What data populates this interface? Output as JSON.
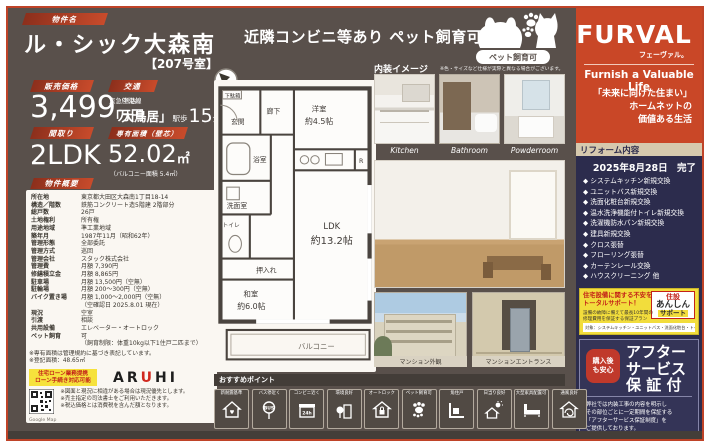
{
  "colors": {
    "page_brown": "#59504b",
    "brand_red": "#c94727",
    "navy": "#2c2c4d",
    "chip_red": "#c0452b",
    "yellow": "#f2dd3c",
    "tan_bar": "#d6c9ae"
  },
  "header": {
    "property_label": "物件名",
    "property_name": "ル・シック大森南",
    "room_no": "【207号室】",
    "banner_text": "近隣コンビニ等あり ペット飼育可能",
    "pet_badge": "ペット飼育可"
  },
  "brand": {
    "logo": "FURVAL",
    "logo_kana": "フェーヴァル。",
    "tagline": "Furnish a Valuable Life",
    "catch1": "「未来に向けた住まい」",
    "catch2": "ホームネットの",
    "catch3": "価値ある生活"
  },
  "summary": {
    "price_label": "販売価格",
    "price_value": "3,499",
    "price_tax": "（税込）",
    "price_unit": "万円",
    "access_label": "交通",
    "access_line": "京急空港線",
    "access_station": "「大鳥居」",
    "access_walk_prefix": "駅歩",
    "access_walk_min": "15",
    "access_walk_suffix": "分",
    "layout_label": "間取り",
    "layout_value": "2LDK",
    "area_label": "専有面積（壁芯）",
    "area_value": "52.02",
    "area_unit": "㎡",
    "balcony_note": "（バルコニー面積 5.4㎡）"
  },
  "overview": {
    "label": "物件概要",
    "rows": [
      [
        "所在地",
        "東京都大田区大森南1丁目18-14"
      ],
      [
        "構造／階数",
        "鉄筋コンクリート造5階建 2階部分"
      ],
      [
        "総戸数",
        "26戸"
      ],
      [
        "土地権利",
        "所有権"
      ],
      [
        "用途地域",
        "準工業地域"
      ],
      [
        "築年月",
        "1987年11月（昭和62年）"
      ],
      [
        "管理形態",
        "全部委託"
      ],
      [
        "管理方式",
        "巡回"
      ],
      [
        "管理会社",
        "スタック株式会社"
      ],
      [
        "管理費",
        "月額 7,390円"
      ],
      [
        "修繕積立金",
        "月額 8,865円"
      ],
      [
        "駐車場",
        "月額 13,500円（空無）"
      ],
      [
        "駐輪場",
        "月額 200〜300円（空無）"
      ],
      [
        "バイク置き場",
        "月額 1,000〜2,000円（空無）"
      ],
      [
        "",
        "（空確認日 2025.8.01 現在）"
      ],
      [
        "現況",
        "空室"
      ],
      [
        "引渡",
        "相談"
      ],
      [
        "共用設備",
        "エレベーター・オートロック"
      ],
      [
        "ペット飼育",
        "可"
      ],
      [
        "",
        "（飼育制限：体重10kg以下1住戸二匹まで）"
      ]
    ],
    "notes": [
      "※専有面積は管理規約に基づき表記しています。",
      "※登記面積：48.65㎡"
    ]
  },
  "loan": {
    "badge_line1": "住宅ローン業務提携",
    "badge_line2": "ローン手続き対応可能",
    "bank_a": "AR",
    "bank_u": "U",
    "bank_hi": "HI"
  },
  "map": {
    "qr_caption": "Google Map"
  },
  "disclaimers": [
    "※図面と現況に相違がある場合は現況優先とします。",
    "※売主指定の司法書士をご利用いただきます。",
    "※税込価格とは消費税を含んだ額となります。"
  ],
  "floorplan": {
    "getabako": "下駄箱",
    "genkan": "玄関",
    "rouka": "廊下",
    "youshitsu": "洋室",
    "youshitsu_size": "約4.5帖",
    "bath": "浴室",
    "senmen": "洗面室",
    "toilet": "トイレ",
    "oshiire": "押入れ",
    "washitsu": "和室",
    "washitsu_size": "約6.0帖",
    "ldk": "LDK",
    "ldk_size": "約13.2帖",
    "fridge": "R",
    "balcony": "バルコニー"
  },
  "interior": {
    "header": "内装イメージ",
    "note": "※色・サイズなど仕様が実際と異なる場合がございます。",
    "photos": [
      {
        "label": "Kitchen"
      },
      {
        "label": "Bathroom"
      },
      {
        "label": "Powderroom"
      }
    ]
  },
  "building_photos": [
    {
      "caption": "マンション外観"
    },
    {
      "caption": "マンションエントランス"
    }
  ],
  "reform": {
    "header": "リフォーム内容",
    "date": "2025年8月28日",
    "status": "完了",
    "items": [
      "システムキッチン新規交換",
      "ユニットバス新規交換",
      "洗面化粧台新規交換",
      "温水洗浄機能付トイレ新規交換",
      "洗濯機防水パン新規交換",
      "建具新規交換",
      "クロス張替",
      "フローリング張替",
      "カーテンレール交換",
      "ハウスクリーニング 他"
    ]
  },
  "support": {
    "title1": "住宅設備に関する不安を",
    "title2": "トータルサポート！",
    "desc1": "設備の故障に備えて最長10年間の",
    "desc2": "修理費用を保証する保証プラン",
    "logo1": "住設",
    "logo2": "あんしん",
    "logo3": "サポート",
    "targets": "対象：システムキッチン・ユニットバス・洗面化粧台・トイレ"
  },
  "warranty": {
    "tab1": "購入後",
    "tab2": "も安心",
    "line1": "アフター",
    "line2": "サービス",
    "line3": "保 証 付",
    "desc": [
      "弊社では内装工事の内容を明示し",
      "その部位ごとに一定期間を保証する",
      "「アフターサービス保証制度」を",
      "ご提供しております。"
    ]
  },
  "points": {
    "header": "おすすめポイント",
    "items": [
      {
        "label": "新耐震基準"
      },
      {
        "label": "バス停近く"
      },
      {
        "label": "コンビニ近く"
      },
      {
        "label": "環境良好"
      },
      {
        "label": "オートロック"
      },
      {
        "label": "ペット飼育可"
      },
      {
        "label": "角住戸"
      },
      {
        "label": "日当り良好"
      },
      {
        "label": "大型家具配置可"
      },
      {
        "label": "通風良好"
      }
    ]
  }
}
